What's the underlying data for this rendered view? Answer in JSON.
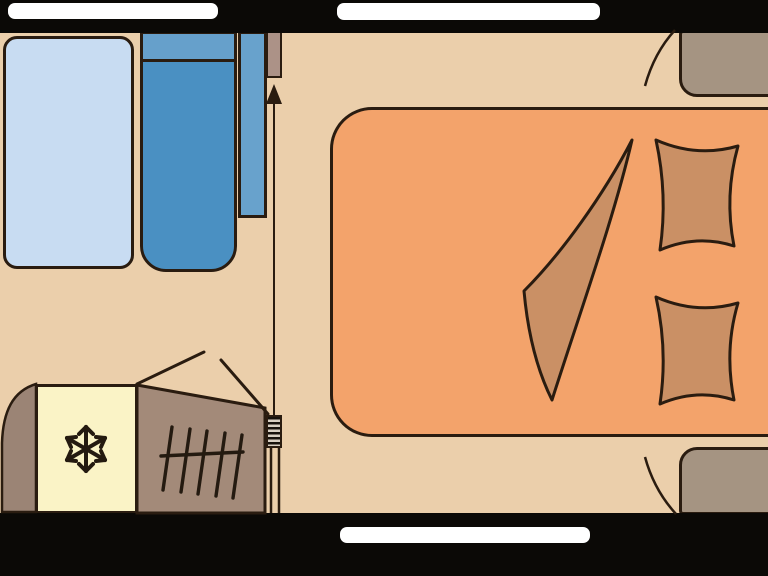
{
  "title": "Caravan interior floor plan",
  "palette": {
    "wall": "#0b0906",
    "floor": "#ebcfab",
    "window": "#ffffff",
    "outline": "#2a1c10",
    "bed": "#f3a36b",
    "bedding": "#ca9065",
    "table": "#c8dcf2",
    "seat": "#4a90c2",
    "seat_band": "#66a0cb",
    "backrest": "#68a2cc",
    "cabinet": "#a59482",
    "fridge": "#faf3c6",
    "kitchen": "#a38a79",
    "panel": "#ac9287",
    "arch": "#9b8475",
    "coil_dark": "#17120c",
    "coil_light": "#d8cfc2",
    "grate": "#241a10"
  },
  "icons": {
    "snowflake_icon": "❄",
    "entrance_arrow_icon": "↑"
  }
}
